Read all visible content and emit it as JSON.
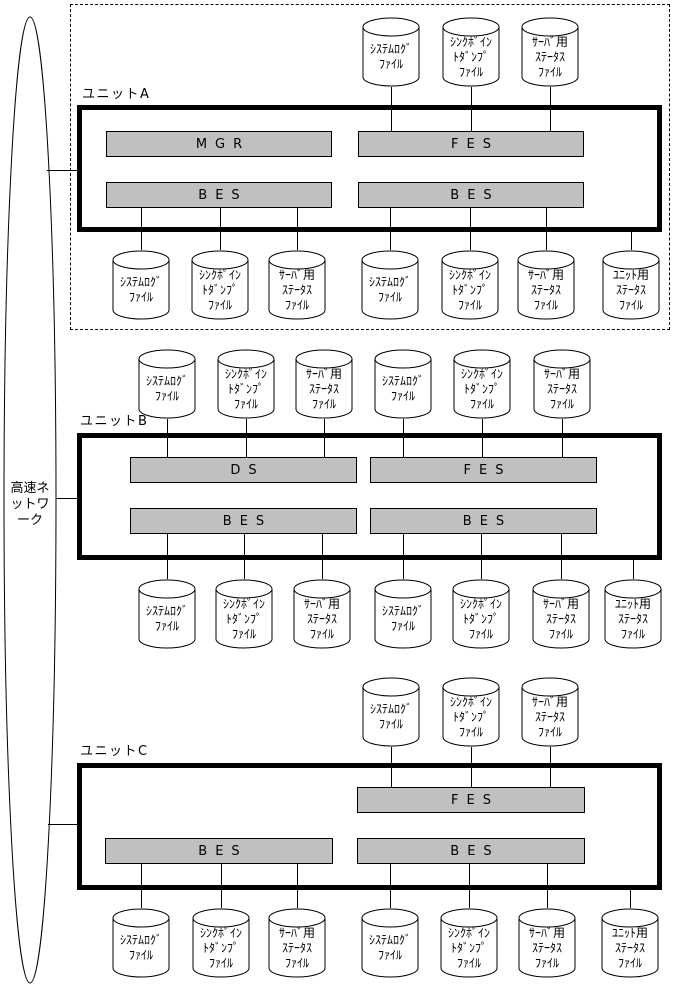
{
  "colors": {
    "background": "#ffffff",
    "line": "#000000",
    "server_box_fill": "#c0c0c0",
    "text": "#000000"
  },
  "network": {
    "full_name": "高速ネットワーク",
    "label_lines": [
      "高速ネ",
      "ットワ",
      "ーク"
    ],
    "ellipse": {
      "cx": 30,
      "cy": 500,
      "rx": 26,
      "ry": 483
    }
  },
  "file_types": {
    "system_log": {
      "full_name": "システムログファイル",
      "lines": [
        "ｼｽﾃﾑﾛｸﾞ",
        "ﾌｧｲﾙ"
      ]
    },
    "sync_point_dump": {
      "full_name": "シンクポイントダンプファイル",
      "lines": [
        "ｼﾝｸﾎﾟｲﾝ",
        "ﾄﾀﾞﾝﾌﾟ",
        "ﾌｧｲﾙ"
      ]
    },
    "server_status": {
      "full_name": "サーバ用ステータスファイル",
      "lines": [
        "ｻｰﾊﾞ用",
        "ｽﾃｰﾀｽ",
        "ﾌｧｲﾙ"
      ]
    },
    "unit_status": {
      "full_name": "ユニット用ステータスファイル",
      "lines": [
        "ﾕﾆｯﾄ用",
        "ｽﾃｰﾀｽ",
        "ﾌｧｲﾙ"
      ]
    }
  },
  "units": [
    {
      "id": "a",
      "label": "ユニットA",
      "label_pos": {
        "x": 82,
        "y": 83
      },
      "box": {
        "x": 77,
        "y": 105,
        "w": 585,
        "h": 127
      },
      "dashed_outline": {
        "x": 70,
        "y": 4,
        "w": 600,
        "h": 326
      },
      "servers": [
        {
          "label": "MGR",
          "x": 106,
          "y": 131,
          "w": 226,
          "h": 26
        },
        {
          "label": "FES",
          "x": 358,
          "y": 131,
          "w": 226,
          "h": 26
        },
        {
          "label": "BES",
          "x": 106,
          "y": 182,
          "w": 226,
          "h": 26
        },
        {
          "label": "BES",
          "x": 358,
          "y": 182,
          "w": 226,
          "h": 26
        }
      ]
    },
    {
      "id": "b",
      "label": "ユニットB",
      "label_pos": {
        "x": 80,
        "y": 410
      },
      "box": {
        "x": 77,
        "y": 433,
        "w": 585,
        "h": 127
      },
      "servers": [
        {
          "label": "DS",
          "x": 130,
          "y": 457,
          "w": 227,
          "h": 26
        },
        {
          "label": "FES",
          "x": 370,
          "y": 457,
          "w": 227,
          "h": 26
        },
        {
          "label": "BES",
          "x": 130,
          "y": 508,
          "w": 227,
          "h": 26
        },
        {
          "label": "BES",
          "x": 370,
          "y": 508,
          "w": 227,
          "h": 26
        }
      ]
    },
    {
      "id": "c",
      "label": "ユニットC",
      "label_pos": {
        "x": 80,
        "y": 740
      },
      "box": {
        "x": 77,
        "y": 763,
        "w": 585,
        "h": 127
      },
      "servers": [
        {
          "label": "FES",
          "x": 357,
          "y": 787,
          "w": 228,
          "h": 26
        },
        {
          "label": "BES",
          "x": 105,
          "y": 838,
          "w": 228,
          "h": 26
        },
        {
          "label": "BES",
          "x": 357,
          "y": 838,
          "w": 228,
          "h": 26
        }
      ]
    }
  ],
  "cylinders": [
    {
      "unit": "a",
      "type": "system_log",
      "cx": 391,
      "y": 17
    },
    {
      "unit": "a",
      "type": "sync_point_dump",
      "cx": 471,
      "y": 17
    },
    {
      "unit": "a",
      "type": "server_status",
      "cx": 550,
      "y": 17
    },
    {
      "unit": "a",
      "type": "system_log",
      "cx": 141,
      "y": 250
    },
    {
      "unit": "a",
      "type": "sync_point_dump",
      "cx": 220,
      "y": 250
    },
    {
      "unit": "a",
      "type": "server_status",
      "cx": 297,
      "y": 250
    },
    {
      "unit": "a",
      "type": "system_log",
      "cx": 390,
      "y": 250
    },
    {
      "unit": "a",
      "type": "sync_point_dump",
      "cx": 470,
      "y": 250
    },
    {
      "unit": "a",
      "type": "server_status",
      "cx": 546,
      "y": 250
    },
    {
      "unit": "a",
      "type": "unit_status",
      "cx": 631,
      "y": 250
    },
    {
      "unit": "b",
      "type": "system_log",
      "cx": 167,
      "y": 349
    },
    {
      "unit": "b",
      "type": "sync_point_dump",
      "cx": 246,
      "y": 349
    },
    {
      "unit": "b",
      "type": "server_status",
      "cx": 324,
      "y": 349
    },
    {
      "unit": "b",
      "type": "system_log",
      "cx": 403,
      "y": 349
    },
    {
      "unit": "b",
      "type": "sync_point_dump",
      "cx": 482,
      "y": 349
    },
    {
      "unit": "b",
      "type": "server_status",
      "cx": 562,
      "y": 349
    },
    {
      "unit": "b",
      "type": "system_log",
      "cx": 167,
      "y": 579
    },
    {
      "unit": "b",
      "type": "sync_point_dump",
      "cx": 244,
      "y": 579
    },
    {
      "unit": "b",
      "type": "server_status",
      "cx": 322,
      "y": 579
    },
    {
      "unit": "b",
      "type": "system_log",
      "cx": 403,
      "y": 579
    },
    {
      "unit": "b",
      "type": "sync_point_dump",
      "cx": 481,
      "y": 579
    },
    {
      "unit": "b",
      "type": "server_status",
      "cx": 561,
      "y": 579
    },
    {
      "unit": "b",
      "type": "unit_status",
      "cx": 633,
      "y": 579
    },
    {
      "unit": "c",
      "type": "system_log",
      "cx": 391,
      "y": 677
    },
    {
      "unit": "c",
      "type": "sync_point_dump",
      "cx": 471,
      "y": 677
    },
    {
      "unit": "c",
      "type": "server_status",
      "cx": 550,
      "y": 677
    },
    {
      "unit": "c",
      "type": "system_log",
      "cx": 141,
      "y": 908
    },
    {
      "unit": "c",
      "type": "sync_point_dump",
      "cx": 221,
      "y": 908
    },
    {
      "unit": "c",
      "type": "server_status",
      "cx": 297,
      "y": 908
    },
    {
      "unit": "c",
      "type": "system_log",
      "cx": 390,
      "y": 908
    },
    {
      "unit": "c",
      "type": "sync_point_dump",
      "cx": 469,
      "y": 908
    },
    {
      "unit": "c",
      "type": "server_status",
      "cx": 547,
      "y": 908
    },
    {
      "unit": "c",
      "type": "unit_status",
      "cx": 630,
      "y": 908
    }
  ],
  "connectors": [
    {
      "x1": 47,
      "y1": 170,
      "x2": 79,
      "y2": 170
    },
    {
      "x1": 56,
      "y1": 498,
      "x2": 79,
      "y2": 498
    },
    {
      "x1": 48,
      "y1": 824,
      "x2": 79,
      "y2": 824
    },
    {
      "x1": 391,
      "y1": 87,
      "x2": 391,
      "y2": 131
    },
    {
      "x1": 471,
      "y1": 87,
      "x2": 471,
      "y2": 131
    },
    {
      "x1": 550,
      "y1": 87,
      "x2": 550,
      "y2": 131
    },
    {
      "x1": 141,
      "y1": 208,
      "x2": 141,
      "y2": 250
    },
    {
      "x1": 220,
      "y1": 208,
      "x2": 220,
      "y2": 250
    },
    {
      "x1": 297,
      "y1": 208,
      "x2": 297,
      "y2": 250
    },
    {
      "x1": 390,
      "y1": 208,
      "x2": 390,
      "y2": 250
    },
    {
      "x1": 470,
      "y1": 208,
      "x2": 470,
      "y2": 250
    },
    {
      "x1": 546,
      "y1": 208,
      "x2": 546,
      "y2": 250
    },
    {
      "x1": 631,
      "y1": 230,
      "x2": 631,
      "y2": 250
    },
    {
      "x1": 167,
      "y1": 419,
      "x2": 167,
      "y2": 457
    },
    {
      "x1": 246,
      "y1": 419,
      "x2": 246,
      "y2": 457
    },
    {
      "x1": 324,
      "y1": 419,
      "x2": 324,
      "y2": 457
    },
    {
      "x1": 403,
      "y1": 419,
      "x2": 403,
      "y2": 457
    },
    {
      "x1": 482,
      "y1": 419,
      "x2": 482,
      "y2": 457
    },
    {
      "x1": 562,
      "y1": 419,
      "x2": 562,
      "y2": 457
    },
    {
      "x1": 167,
      "y1": 534,
      "x2": 167,
      "y2": 579
    },
    {
      "x1": 244,
      "y1": 534,
      "x2": 244,
      "y2": 579
    },
    {
      "x1": 322,
      "y1": 534,
      "x2": 322,
      "y2": 579
    },
    {
      "x1": 403,
      "y1": 534,
      "x2": 403,
      "y2": 579
    },
    {
      "x1": 481,
      "y1": 534,
      "x2": 481,
      "y2": 579
    },
    {
      "x1": 561,
      "y1": 534,
      "x2": 561,
      "y2": 579
    },
    {
      "x1": 633,
      "y1": 558,
      "x2": 633,
      "y2": 579
    },
    {
      "x1": 391,
      "y1": 747,
      "x2": 391,
      "y2": 787
    },
    {
      "x1": 471,
      "y1": 747,
      "x2": 471,
      "y2": 787
    },
    {
      "x1": 550,
      "y1": 747,
      "x2": 550,
      "y2": 787
    },
    {
      "x1": 141,
      "y1": 864,
      "x2": 141,
      "y2": 908
    },
    {
      "x1": 221,
      "y1": 864,
      "x2": 221,
      "y2": 908
    },
    {
      "x1": 297,
      "y1": 864,
      "x2": 297,
      "y2": 908
    },
    {
      "x1": 390,
      "y1": 864,
      "x2": 390,
      "y2": 908
    },
    {
      "x1": 469,
      "y1": 864,
      "x2": 469,
      "y2": 908
    },
    {
      "x1": 547,
      "y1": 864,
      "x2": 547,
      "y2": 908
    },
    {
      "x1": 630,
      "y1": 888,
      "x2": 630,
      "y2": 908
    }
  ]
}
